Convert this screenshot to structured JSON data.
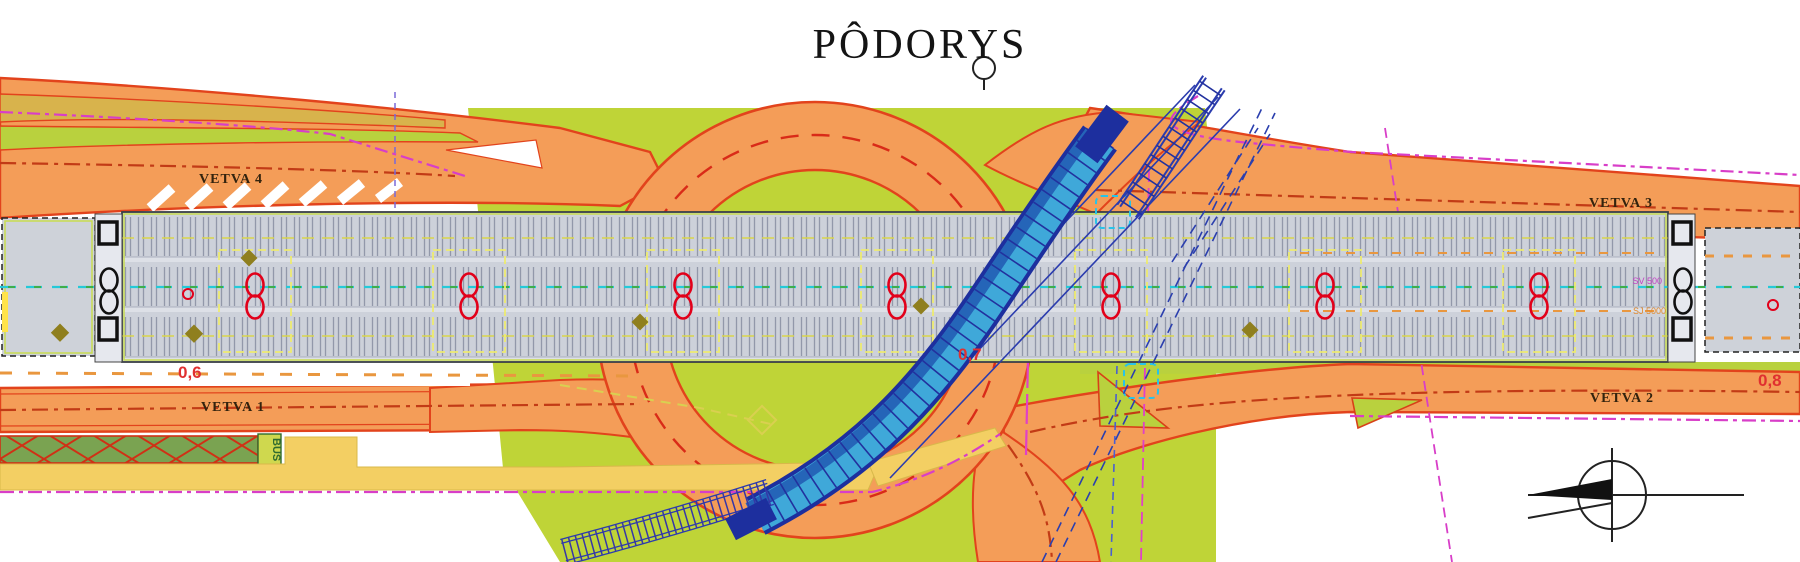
{
  "title": "PÔDORYS",
  "road_labels": {
    "vetva4": "VETVA 4",
    "vetva1": "VETVA 1",
    "vetva3": "VETVA 3",
    "vetva2": "VETVA 2"
  },
  "dimensions": {
    "d_left": "0,6",
    "d_center": "0,7",
    "d_right": "0,8"
  },
  "bridge_labels": {
    "sv": "SV 500",
    "sj": "SJ 5000"
  },
  "transit": {
    "bus": "BUS"
  },
  "symbols": {
    "north_arrow": "north-arrow"
  },
  "colors": {
    "road_fill": "#f49d58",
    "road_edge": "#e2431c",
    "green_area": "#bfd437",
    "deck_gray": "#cdd1da",
    "ramp_blue": "#3fa8d9",
    "navy": "#1d2f9e",
    "magenta": "#d83ec8",
    "measure_red": "#e03030"
  }
}
